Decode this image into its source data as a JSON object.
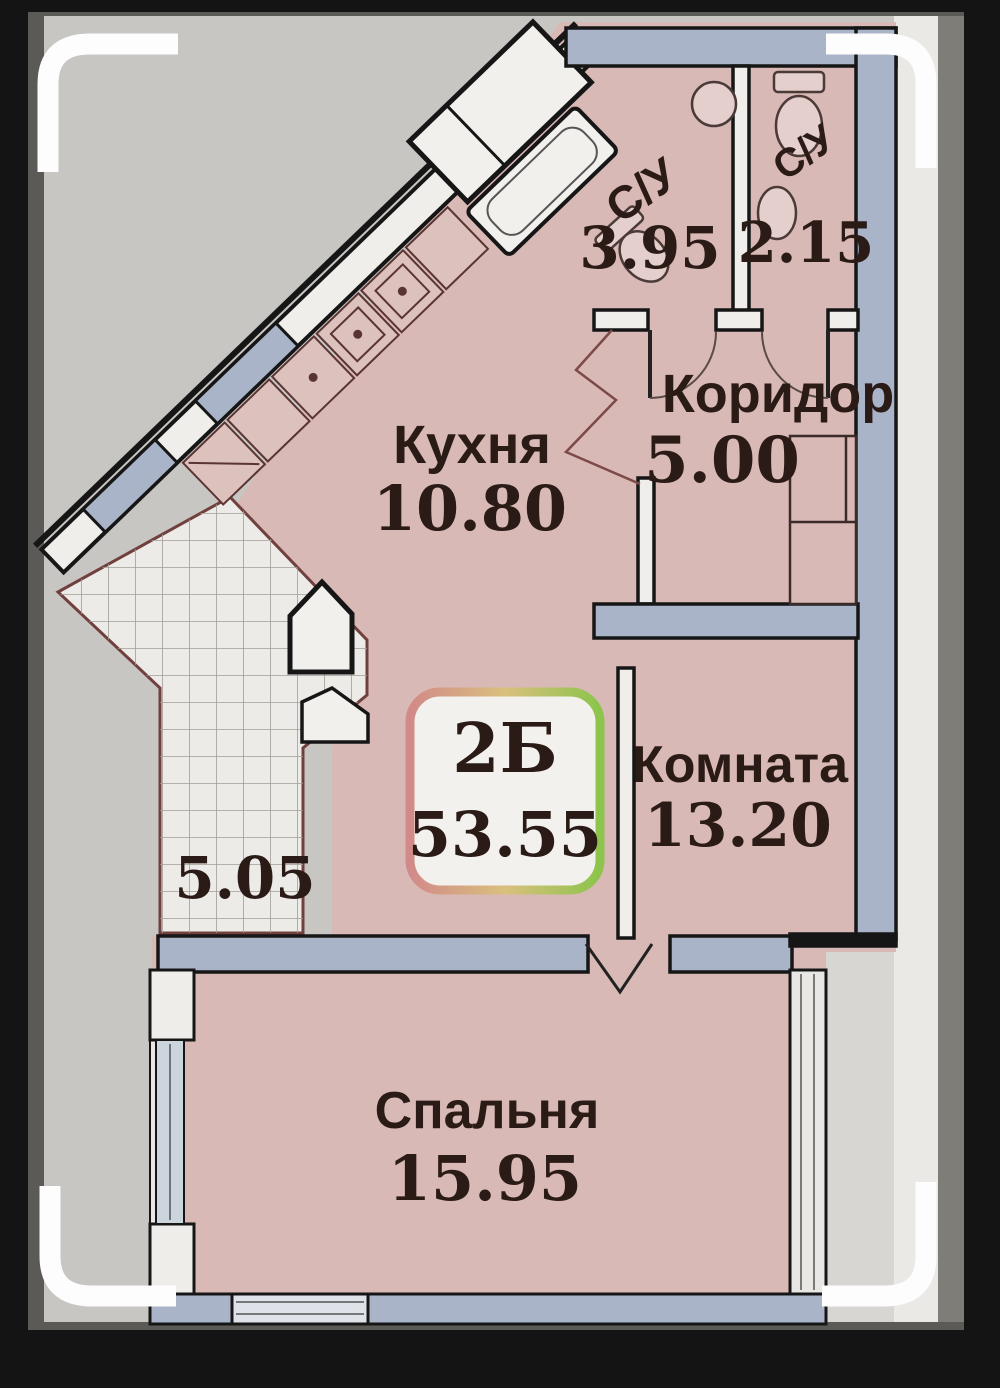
{
  "badge": {
    "unit_type": "2Б",
    "total_area": "53.55",
    "border_left_color": "#d28a88",
    "border_right_color": "#8cc44c"
  },
  "rooms": {
    "kitchen": {
      "name": "Кухня",
      "area": "10.80"
    },
    "corridor": {
      "name": "Коридор",
      "area": "5.00"
    },
    "bathroom_large": {
      "name": "С/У",
      "area": "3.95"
    },
    "bathroom_small": {
      "name": "С/У",
      "area": "2.15"
    },
    "living_room": {
      "name": "Комната",
      "area": "13.20"
    },
    "bedroom": {
      "name": "Спальня",
      "area": "15.95"
    },
    "balcony": {
      "area": "5.05"
    }
  },
  "colors": {
    "room_fill": "#d9b9b6",
    "wall_fill": "#a9b4c8",
    "canvas_gray": "#c8c6c3",
    "line_black": "#161616",
    "text": "#2b1b17"
  }
}
